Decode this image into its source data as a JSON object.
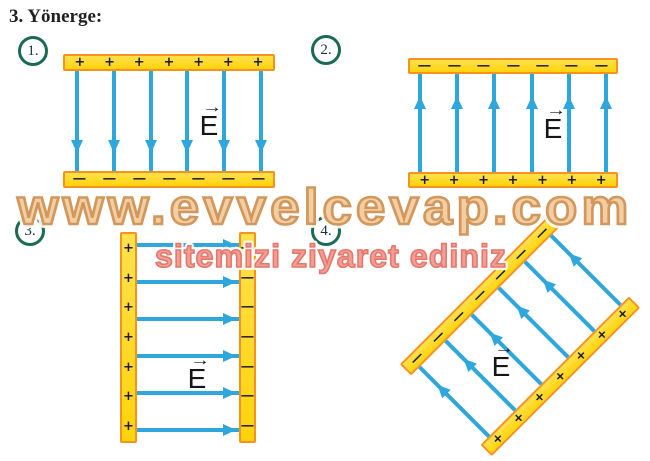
{
  "title": "3. Yönerge:",
  "watermark": {
    "line1": "www.evvelcevap.com",
    "line2": "sitemizi ziyaret ediniz"
  },
  "colors": {
    "plate_fill": "#ffd30a",
    "plate_fill_light": "#ffe14d",
    "plate_border": "#f6921e",
    "field_line": "#2fa6dc",
    "sign": "#1b1b35",
    "circle_border": "#1a6b52",
    "text": "#231f20",
    "watermark1_fill": "#f2cb9b",
    "watermark1_stroke": "#cf9050",
    "watermark2_fill": "#f4948a",
    "watermark2_stroke": "#e06a5d"
  },
  "diagrams": [
    {
      "number": "1.",
      "orientation": "horizontal-plates",
      "field_direction": "down",
      "rotation_deg": 0,
      "plates": [
        {
          "position": "top",
          "sign": "+",
          "count": 7
        },
        {
          "position": "bottom",
          "sign": "−",
          "count": 7
        }
      ],
      "field_line_count": 6,
      "e_label": "E",
      "e_arrow": "→"
    },
    {
      "number": "2.",
      "orientation": "horizontal-plates",
      "field_direction": "up",
      "rotation_deg": 0,
      "plates": [
        {
          "position": "top",
          "sign": "−",
          "count": 7
        },
        {
          "position": "bottom",
          "sign": "+",
          "count": 7
        }
      ],
      "field_line_count": 6,
      "e_label": "E",
      "e_arrow": "→"
    },
    {
      "number": "3.",
      "orientation": "vertical-plates",
      "field_direction": "right",
      "rotation_deg": 0,
      "plates": [
        {
          "position": "left",
          "sign": "+",
          "count": 7
        },
        {
          "position": "right",
          "sign": "−",
          "count": 7
        }
      ],
      "field_line_count": 6,
      "e_label": "E",
      "e_arrow": "→"
    },
    {
      "number": "4.",
      "orientation": "tilted-plates",
      "field_direction": "up-left",
      "rotation_deg": -45,
      "plates": [
        {
          "position": "upper-left",
          "sign": "−",
          "count": 7
        },
        {
          "position": "lower-right",
          "sign": "+",
          "count": 7
        }
      ],
      "field_line_count": 6,
      "e_label": "E",
      "e_arrow": "→"
    }
  ]
}
